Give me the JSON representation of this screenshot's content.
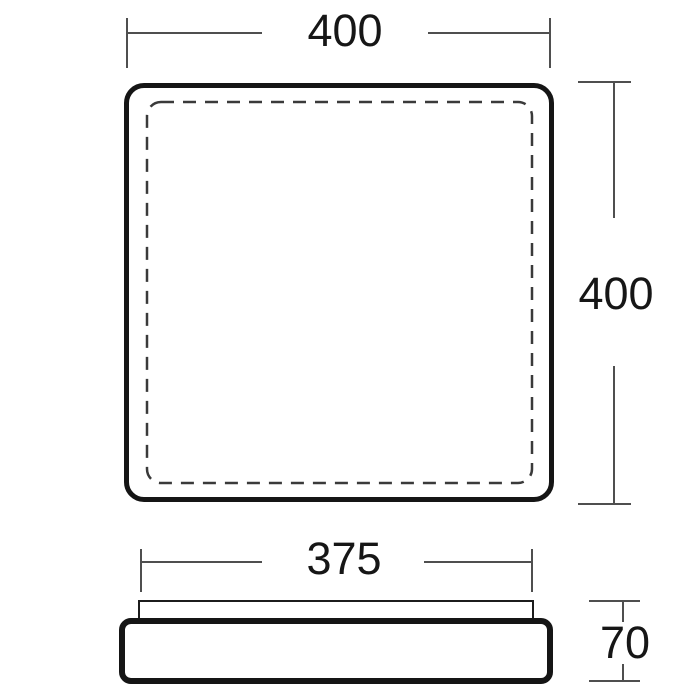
{
  "drawing": {
    "description": "two-view dimensioned technical drawing of a square fixture",
    "top_view": {
      "width_label": "400",
      "height_label": "400"
    },
    "side_view": {
      "width_label": "375",
      "height_label": "70"
    },
    "colors": {
      "outline": "#151515",
      "dashed_outline": "#3a3a3a",
      "dimension_line": "#4f4f4f",
      "label_text": "#161616",
      "background": "#ffffff"
    }
  }
}
